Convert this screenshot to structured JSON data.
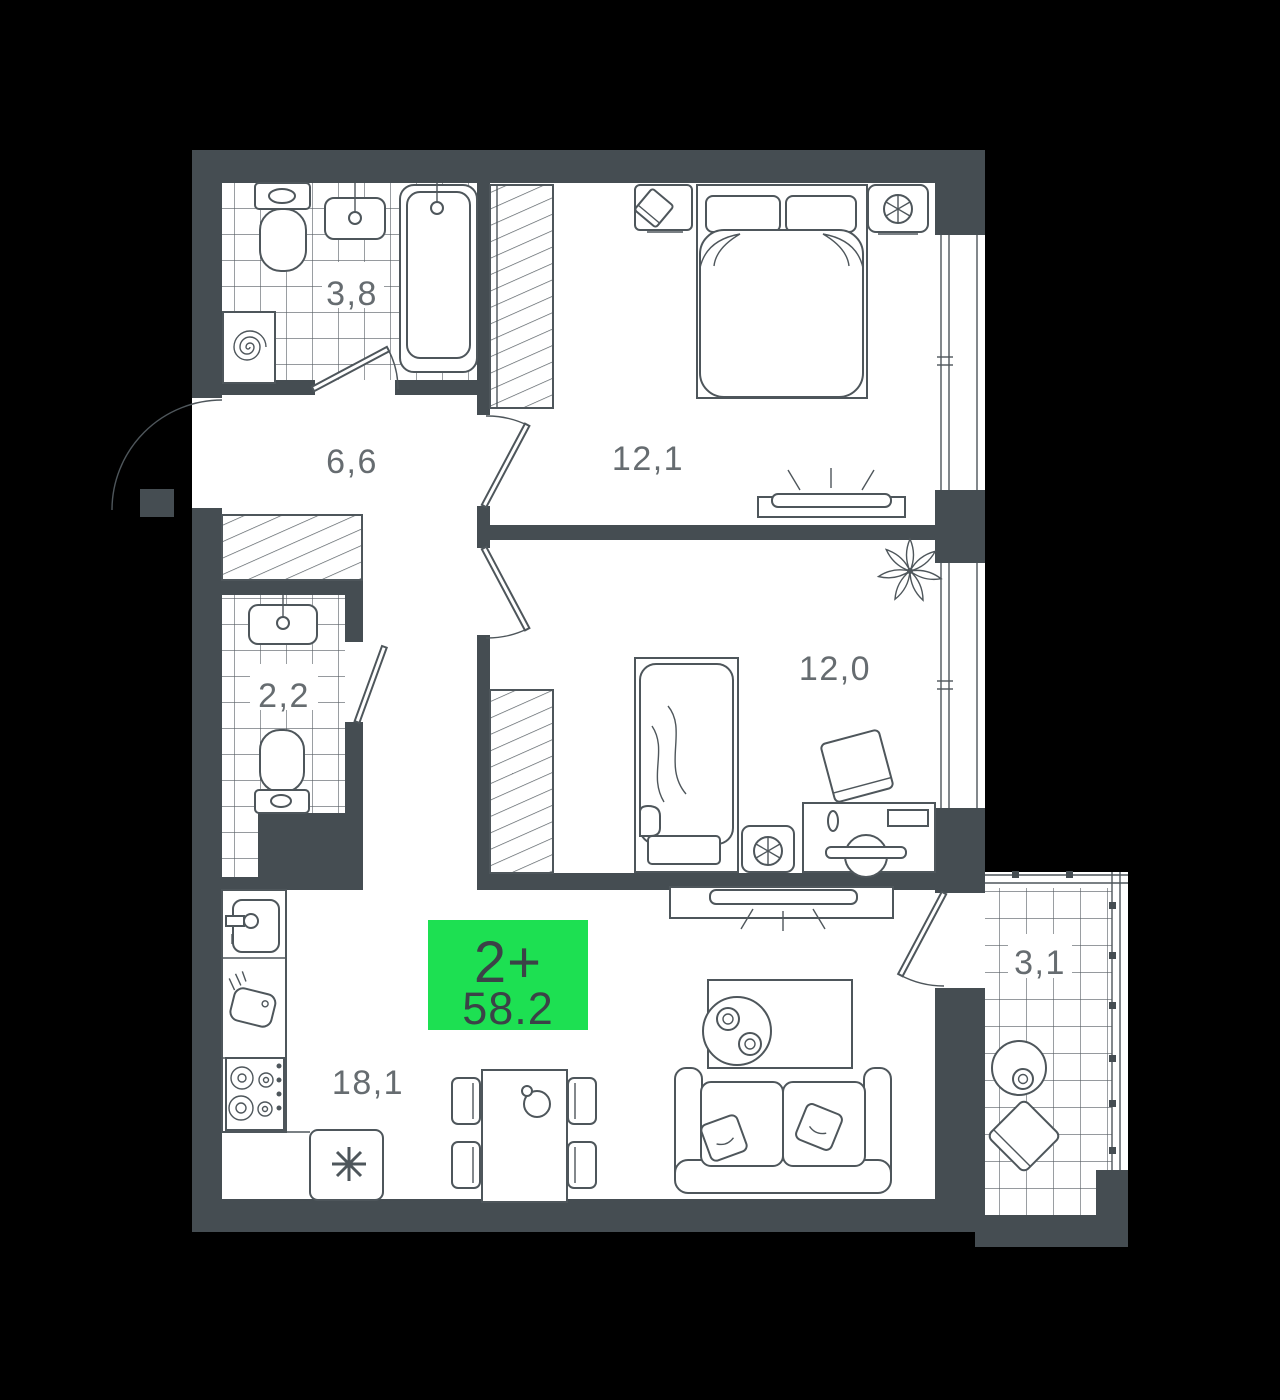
{
  "floor_plan": {
    "badge": {
      "rooms_label": "2+",
      "area_value": "58.2",
      "background": "#1de052",
      "text_color": "#3b4247"
    },
    "rooms": [
      {
        "name": "bathroom",
        "area": "3,8"
      },
      {
        "name": "hallway",
        "area": "6,6"
      },
      {
        "name": "bedroom-1",
        "area": "12,1"
      },
      {
        "name": "toilet",
        "area": "2,2"
      },
      {
        "name": "bedroom-2",
        "area": "12,0"
      },
      {
        "name": "kitchen-living-room",
        "area": "18,1"
      },
      {
        "name": "balcony",
        "area": "3,1"
      }
    ],
    "colors": {
      "wall": "#454d52",
      "line": "#4e565b",
      "floor": "#ffffff",
      "background": "#000000",
      "label": "#666c70"
    }
  }
}
